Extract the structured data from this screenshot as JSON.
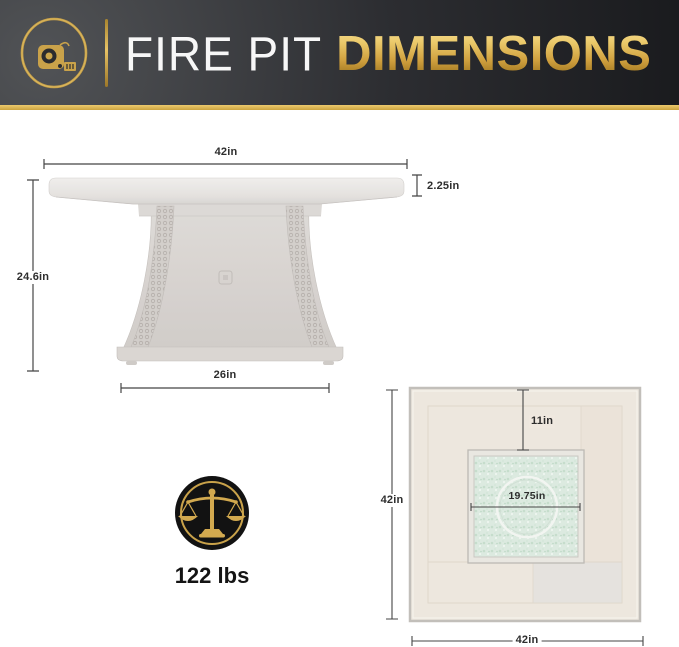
{
  "header": {
    "brand_icon": "tape-measure-icon",
    "title": "FIRE PIT",
    "title_accent": "DIMENSIONS"
  },
  "side_view": {
    "name": "fire pit side elevation",
    "labels": {
      "top_width": "42in",
      "top_thickness": "2.25in",
      "height": "24.6in",
      "base_width": "26in"
    }
  },
  "weight": {
    "icon": "balance-scale-icon",
    "value": "122 lbs"
  },
  "top_view": {
    "name": "fire pit top view",
    "labels": {
      "height": "42in",
      "width": "42in",
      "edge_to_burner": "11in",
      "burner_diameter": "19.75in"
    }
  },
  "colors": {
    "gold": "#cfa345",
    "header_dark": "#2c2d31",
    "dimension_text": "#2d2d2d",
    "fire_glass": "#dbe9df",
    "table_tile": "#ede6dd"
  }
}
